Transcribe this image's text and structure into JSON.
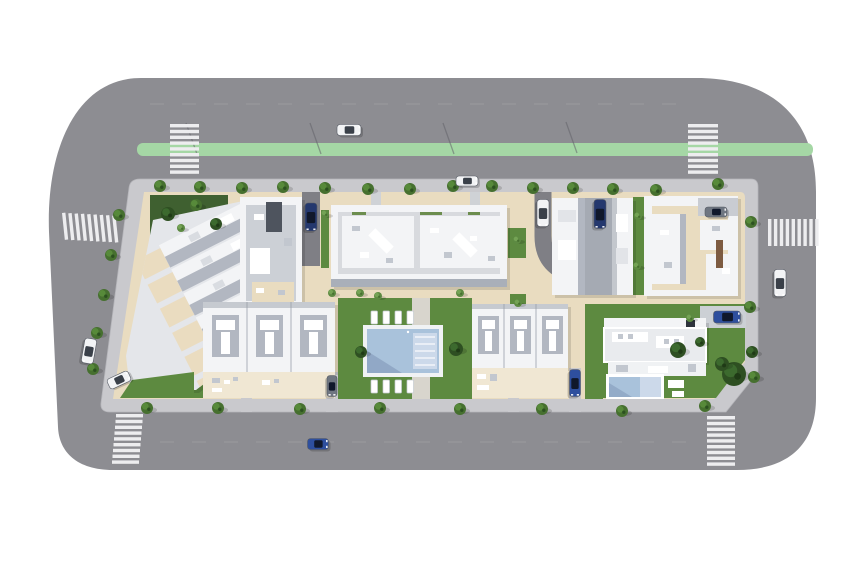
{
  "scene": {
    "type": "aerial-3d-site-plan",
    "description": "Top-down 3D architectural rendering of a residential block: apartment buildings and townhouse rows around a communal pool garden, a detached villa with private pool, perimeter roads with a green bike lane, zebra crosswalks, street trees and parked cars on a white background",
    "elements": [
      "perimeter-road",
      "bike-lane",
      "crosswalks",
      "sidewalk-ring",
      "left-townhouse-block",
      "north-apartment-building",
      "north-east-twin-building",
      "east-apartment-building",
      "south-townhouse-row-west",
      "south-townhouse-row-east",
      "communal-pool-garden",
      "villa-with-private-pool",
      "street-trees",
      "parked-cars"
    ]
  },
  "colors": {
    "road": "#8d8d92",
    "road_dark": "#7f7f85",
    "sidewalk": "#c9c9cd",
    "curb": "#dcdcdf",
    "bike_lane": "#a5d7a5",
    "crosswalk": "#ededef",
    "plot": "#e9dcc0",
    "plot_light": "#f0e7d3",
    "lawn": "#5d8a40",
    "lawn_dark": "#3f6030",
    "roof_white": "#f3f4f6",
    "roof_shade": "#b2b7c1",
    "roof_mid": "#d8dade",
    "court": "#a5aab3",
    "pool_water": "#a9c2db",
    "pool_water_light": "#ccd9ea",
    "pool_shade": "#7e94b5",
    "deck": "#f0f2f4",
    "car_white": "#f2f3f5",
    "car_dark_blue": "#24386e",
    "car_blue": "#2e4f9e",
    "car_gray": "#6f7681",
    "tree": "#46702f",
    "tree_light": "#578a3a",
    "tree_dark": "#2c5120",
    "shrub": "#5d8a42",
    "shrub_light": "#74a355",
    "bush_dark": "#2e4f22",
    "bush_dark_light": "#3c6a2e"
  },
  "road": {
    "bike_lane": {
      "x": 137,
      "y": 143,
      "w": 676,
      "h": 13
    },
    "lane_dashes": [
      {
        "x1": 150,
        "y1": 104,
        "x2": 690,
        "y2": 104
      },
      {
        "x1": 160,
        "y1": 442,
        "x2": 700,
        "y2": 442
      }
    ],
    "lamp_shadows": [
      [
        186,
        123
      ],
      [
        310,
        123
      ],
      [
        443,
        123
      ],
      [
        566,
        122
      ]
    ],
    "crosswalks": [
      {
        "x": 170,
        "y": 124,
        "sw": 29,
        "sh": 3.4,
        "n": 9,
        "dx": 0,
        "dy": 5.8,
        "angle": 0
      },
      {
        "x": 688,
        "y": 124,
        "sw": 30,
        "sh": 3.4,
        "n": 9,
        "dx": 0,
        "dy": 5.8,
        "angle": 0
      },
      {
        "x": 62,
        "y": 213,
        "sw": 3.4,
        "sh": 27,
        "n": 9,
        "dx": 6.2,
        "dy": 1.0,
        "angle": -6
      },
      {
        "x": 116,
        "y": 414,
        "sw": 27,
        "sh": 3.4,
        "n": 9,
        "dx": -0.5,
        "dy": 5.8,
        "angle": 0
      },
      {
        "x": 707,
        "y": 416,
        "sw": 28,
        "sh": 3.4,
        "n": 9,
        "dx": 0,
        "dy": 5.8,
        "angle": 0
      },
      {
        "x": 768,
        "y": 219,
        "sw": 3.4,
        "sh": 27,
        "n": 9,
        "dx": 5.9,
        "dy": 0,
        "angle": 0
      }
    ]
  },
  "vegetation": {
    "trees": [
      {
        "x": 160,
        "y": 186,
        "r": 6,
        "v": "t"
      },
      {
        "x": 200,
        "y": 187,
        "r": 6,
        "v": "t"
      },
      {
        "x": 242,
        "y": 188,
        "r": 6,
        "v": "t"
      },
      {
        "x": 283,
        "y": 187,
        "r": 6,
        "v": "t"
      },
      {
        "x": 325,
        "y": 188,
        "r": 6,
        "v": "t"
      },
      {
        "x": 368,
        "y": 189,
        "r": 6,
        "v": "t"
      },
      {
        "x": 410,
        "y": 189,
        "r": 6,
        "v": "t"
      },
      {
        "x": 453,
        "y": 186,
        "r": 6,
        "v": "t"
      },
      {
        "x": 492,
        "y": 186,
        "r": 6,
        "v": "t"
      },
      {
        "x": 533,
        "y": 188,
        "r": 6,
        "v": "t"
      },
      {
        "x": 573,
        "y": 188,
        "r": 6,
        "v": "t"
      },
      {
        "x": 613,
        "y": 189,
        "r": 6,
        "v": "t"
      },
      {
        "x": 656,
        "y": 190,
        "r": 6,
        "v": "t"
      },
      {
        "x": 718,
        "y": 184,
        "r": 6,
        "v": "t"
      },
      {
        "x": 751,
        "y": 222,
        "r": 6,
        "v": "t"
      },
      {
        "x": 750,
        "y": 307,
        "r": 6,
        "v": "t"
      },
      {
        "x": 754,
        "y": 377,
        "r": 6,
        "v": "t"
      },
      {
        "x": 147,
        "y": 408,
        "r": 6,
        "v": "t"
      },
      {
        "x": 218,
        "y": 408,
        "r": 6,
        "v": "t"
      },
      {
        "x": 300,
        "y": 409,
        "r": 6,
        "v": "t"
      },
      {
        "x": 380,
        "y": 408,
        "r": 6,
        "v": "t"
      },
      {
        "x": 460,
        "y": 409,
        "r": 6,
        "v": "t"
      },
      {
        "x": 542,
        "y": 409,
        "r": 6,
        "v": "t"
      },
      {
        "x": 622,
        "y": 411,
        "r": 6,
        "v": "t"
      },
      {
        "x": 705,
        "y": 406,
        "r": 6,
        "v": "t"
      },
      {
        "x": 119,
        "y": 215,
        "r": 6,
        "v": "t"
      },
      {
        "x": 111,
        "y": 255,
        "r": 6,
        "v": "t"
      },
      {
        "x": 104,
        "y": 295,
        "r": 6,
        "v": "t"
      },
      {
        "x": 97,
        "y": 333,
        "r": 6,
        "v": "t"
      },
      {
        "x": 93,
        "y": 369,
        "r": 6,
        "v": "t"
      },
      {
        "x": 168,
        "y": 214,
        "r": 7,
        "v": "d"
      },
      {
        "x": 196,
        "y": 205,
        "r": 6,
        "v": "t"
      },
      {
        "x": 216,
        "y": 224,
        "r": 6,
        "v": "d"
      },
      {
        "x": 181,
        "y": 228,
        "r": 4,
        "v": "s"
      },
      {
        "x": 332,
        "y": 293,
        "r": 4,
        "v": "s"
      },
      {
        "x": 360,
        "y": 293,
        "r": 4,
        "v": "s"
      },
      {
        "x": 378,
        "y": 296,
        "r": 4,
        "v": "s"
      },
      {
        "x": 460,
        "y": 293,
        "r": 4,
        "v": "s"
      },
      {
        "x": 325,
        "y": 214,
        "r": 4,
        "v": "s"
      },
      {
        "x": 517,
        "y": 240,
        "r": 4,
        "v": "s"
      },
      {
        "x": 518,
        "y": 303,
        "r": 4,
        "v": "s"
      },
      {
        "x": 638,
        "y": 216,
        "r": 4,
        "v": "s"
      },
      {
        "x": 637,
        "y": 266,
        "r": 4,
        "v": "s"
      },
      {
        "x": 690,
        "y": 318,
        "r": 4,
        "v": "s"
      },
      {
        "x": 361,
        "y": 352,
        "r": 6,
        "v": "d"
      },
      {
        "x": 456,
        "y": 349,
        "r": 7,
        "v": "d"
      },
      {
        "x": 678,
        "y": 350,
        "r": 8,
        "v": "d"
      },
      {
        "x": 734,
        "y": 374,
        "r": 12,
        "v": "d"
      },
      {
        "x": 722,
        "y": 364,
        "r": 7,
        "v": "d"
      },
      {
        "x": 752,
        "y": 352,
        "r": 6,
        "v": "d"
      },
      {
        "x": 700,
        "y": 342,
        "r": 5,
        "v": "d"
      }
    ]
  },
  "vehicles": {
    "cars": [
      {
        "x": 349,
        "y": 130,
        "len": 24,
        "wid": 11,
        "angle": 0,
        "color": "car_white",
        "name": "car-top-road"
      },
      {
        "x": 467,
        "y": 181,
        "len": 22,
        "wid": 10,
        "angle": 0,
        "color": "car_white",
        "name": "car-parked-top"
      },
      {
        "x": 311,
        "y": 217,
        "len": 28,
        "wid": 12,
        "angle": 90,
        "color": "car_dark_blue",
        "name": "car-driveway-west"
      },
      {
        "x": 543,
        "y": 213,
        "len": 27,
        "wid": 12,
        "angle": 90,
        "color": "car_white",
        "name": "car-driveway-east"
      },
      {
        "x": 600,
        "y": 214,
        "len": 29,
        "wid": 12,
        "angle": 90,
        "color": "car_dark_blue",
        "name": "car-courtyard"
      },
      {
        "x": 716,
        "y": 212,
        "len": 22,
        "wid": 10,
        "angle": 0,
        "color": "car_gray",
        "name": "car-east-building"
      },
      {
        "x": 780,
        "y": 283,
        "len": 27,
        "wid": 12,
        "angle": 90,
        "color": "car_white",
        "name": "car-right-road"
      },
      {
        "x": 89,
        "y": 351,
        "len": 25,
        "wid": 12,
        "angle": 100,
        "color": "car_white",
        "name": "car-left-road-1"
      },
      {
        "x": 119,
        "y": 380,
        "len": 23,
        "wid": 11,
        "angle": -25,
        "color": "car_white",
        "name": "car-left-road-2"
      },
      {
        "x": 318,
        "y": 444,
        "len": 21,
        "wid": 11,
        "angle": 0,
        "color": "car_blue",
        "name": "car-bottom-road"
      },
      {
        "x": 575,
        "y": 383,
        "len": 27,
        "wid": 11,
        "angle": 90,
        "color": "car_blue",
        "name": "car-south-apron"
      },
      {
        "x": 332,
        "y": 386,
        "len": 21,
        "wid": 10,
        "angle": 90,
        "color": "car_gray",
        "name": "car-townhouse-apron"
      },
      {
        "x": 727,
        "y": 317,
        "len": 27,
        "wid": 12,
        "angle": 0,
        "color": "car_blue",
        "name": "car-villa"
      }
    ]
  },
  "pool": {
    "communal": {
      "loungers": [
        [
          371,
          311
        ],
        [
          383,
          311
        ],
        [
          395,
          311
        ],
        [
          407,
          311
        ],
        [
          371,
          380
        ],
        [
          383,
          380
        ],
        [
          395,
          380
        ],
        [
          407,
          380
        ]
      ],
      "step_lines": 5
    },
    "villa": {
      "step_lines": 3
    }
  }
}
